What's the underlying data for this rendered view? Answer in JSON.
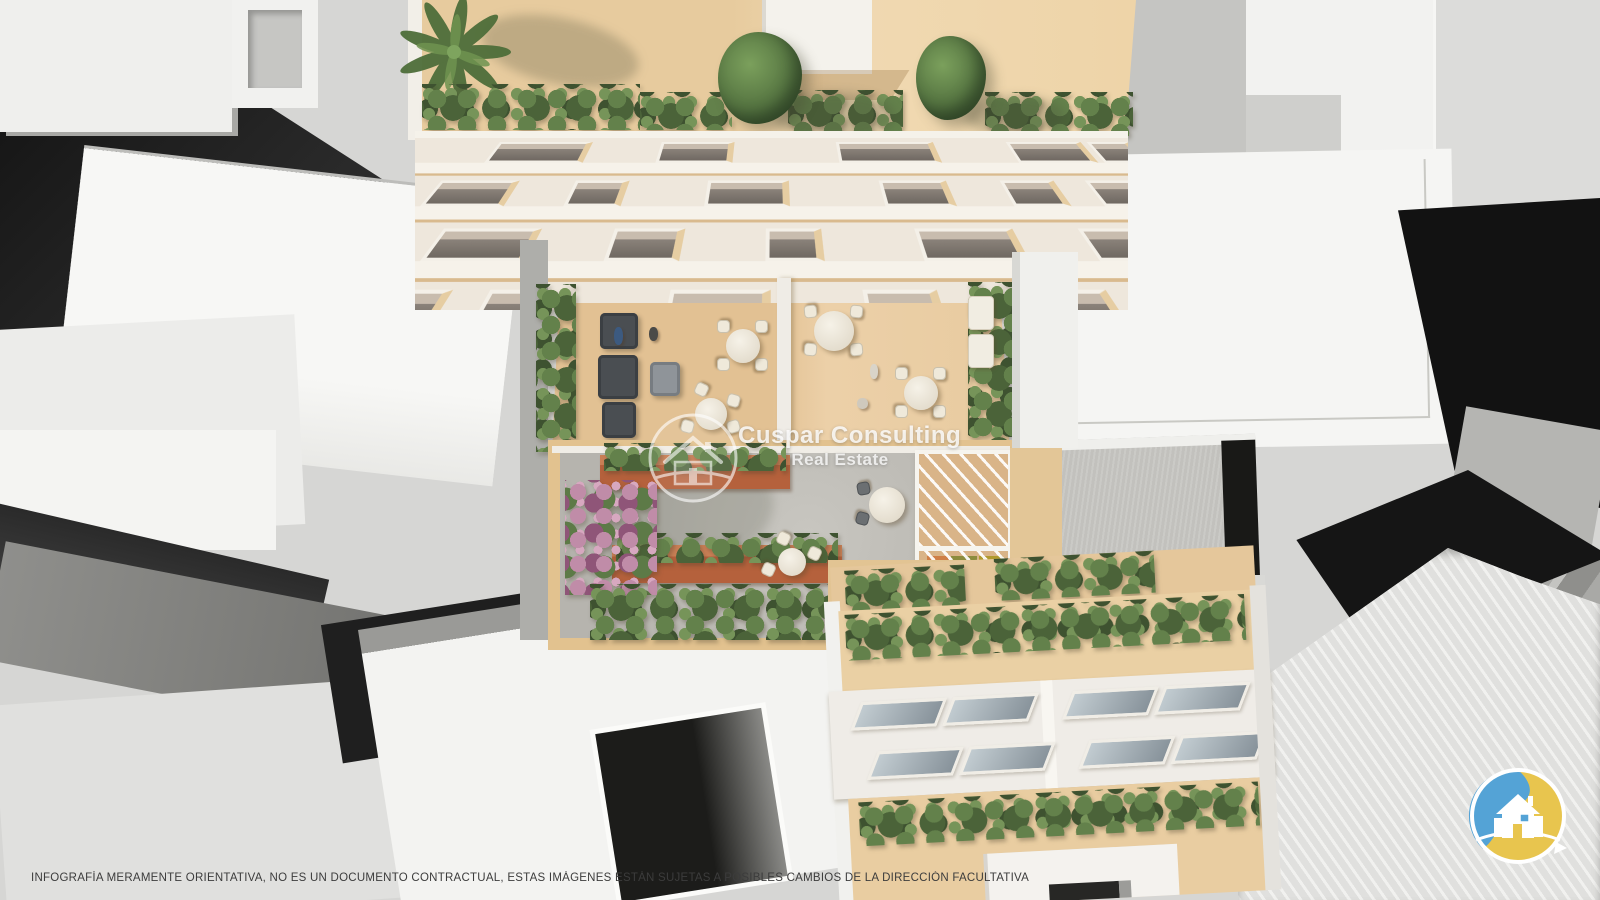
{
  "watermark": {
    "brand": "Cuspar Consulting",
    "division": "Real Estate"
  },
  "footer": {
    "disclaimer": "INFOGRAFÍA MERAMENTE ORIENTATIVA, NO ES UN DOCUMENTO CONTRACTUAL, ESTAS IMÁGENES ESTÁN SUJETAS A POSIBLES CAMBIOS DE LA DIRECCIÓN FACULTATIVA"
  },
  "corner_logo": {
    "name": "cuspar-house-badge",
    "blue": "#54a3d6",
    "yellow": "#e8c54e",
    "house": "#ffffff"
  },
  "scene": {
    "type": "aerial-architectural-render",
    "palette": {
      "roof_deck_wood": "#eacfa3",
      "courtyard_deck_wood": "#e2c193",
      "plaza_paving": "#bcbab4",
      "planter_terracotta": "#b5613c",
      "hedge_green": "#5d7a47",
      "facade_cream": "#eee7dc",
      "massing_white": "#f3f3f1",
      "massing_dark": "#161616",
      "pergola_mat_orange": "#cf7f47",
      "pergola_mat_olive": "#8c8c3e",
      "pergola_mat_yellow": "#b09a2e"
    }
  }
}
